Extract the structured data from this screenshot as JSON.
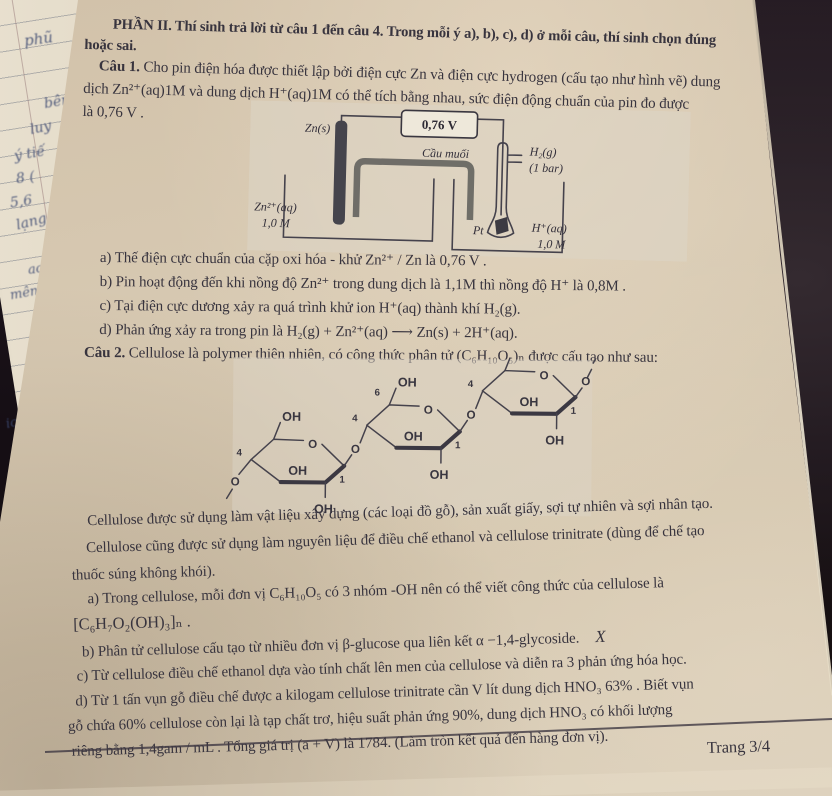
{
  "paper": {
    "header": {
      "line1": "PHẦN II. Thí sinh trả lời từ câu 1 đến câu 4. Trong mỗi ý a), b), c), d) ở mỗi câu, thí sinh chọn đúng",
      "line2": "hoặc sai."
    },
    "q1": {
      "label": "Câu 1.",
      "line1_rest": " Cho pin điện hóa được thiết lập bởi điện cực Zn và điện cực hydrogen (cấu tạo như hình vẽ) dung",
      "line2": "dịch Zn²⁺(aq)1M và dung dịch H⁺(aq)1M có thể tích bằng nhau, sức điện động chuẩn của pin đo được",
      "line3": "là 0,76 V ."
    },
    "diagram": {
      "voltmeter": "0,76 V",
      "zn_label": "Zn(s)",
      "salt_bridge": "Cầu muối",
      "h2": "H₂(g)",
      "bar": "(1 bar)",
      "zn_sol": "Zn²⁺(aq)",
      "zn_conc": "1,0 M",
      "pt": "Pt",
      "h_sol": "H⁺(aq)",
      "h_conc": "1,0 M"
    },
    "q1_opts": {
      "a": "a) Thế điện cực chuẩn của cặp oxi hóa - khử Zn²⁺ / Zn là 0,76 V .",
      "b": "b) Pin hoạt động đến khi nồng độ Zn²⁺ trong dung dịch là 1,1M thì nồng độ H⁺ là 0,8M .",
      "c": "c) Tại điện cực dương xảy ra quá trình khử ion H⁺(aq) thành khí H₂(g).",
      "d": "d) Phản ứng xảy ra trong pin là H₂(g) + Zn²⁺(aq) ⟶ Zn(s) + 2H⁺(aq)."
    },
    "q2": {
      "label": "Câu 2.",
      "intro": " Cellulose là polymer thiên nhiên, có công thức phân tử (C₆H₁₀O₅)ₙ được cấu tạo như sau:"
    },
    "structure": {
      "oh": "OH",
      "o": "O",
      "c1": "1",
      "c4": "4",
      "c6": "6"
    },
    "q2_text": {
      "p1": "Cellulose được sử dụng làm vật liệu xây dựng (các loại đồ gỗ), sản xuất giấy, sợi tự nhiên và sợi nhân tạo.",
      "p2": "Cellulose cũng được sử dụng làm nguyên liệu để điều chế ethanol và cellulose trinitrate (dùng để chế tạo",
      "p3": "thuốc súng không khói)."
    },
    "q2_opts": {
      "a1": "a) Trong cellulose, mỗi đơn vị C₆H₁₀O₅ có 3 nhóm -OH nên có thể viết công thức của cellulose là",
      "a2": "[C₆H₇O₂(OH)₃]ₙ .",
      "b": "b) Phân tử cellulose cấu tạo từ nhiều đơn vị β-glucose qua liên kết α −1,4-glycoside.",
      "b_mark": "X",
      "c": "c) Từ cellulose điều chế ethanol dựa vào tính chất lên men của cellulose và diễn ra 3 phản ứng hóa học.",
      "d1": "d) Từ 1 tấn vụn gỗ điều chế được a kilogam cellulose trinitrate cần V lít dung dịch HNO₃ 63% . Biết vụn",
      "d2": "gỗ chứa 60% cellulose còn lại là tạp chất trơ, hiệu suất phản ứng 90%, dung dịch HNO₃ có khối lượng",
      "d3": "riêng bằng 1,4gam / mL . Tổng giá trị (a + V) là 1784. (Làm tròn kết quả đến hàng đơn vị)."
    },
    "footer": {
      "page": "Trang 3/4"
    }
  },
  "notebook": {
    "f1": "phũ",
    "f2": "bên",
    "f3": "luy",
    "f4": "ý tiế",
    "f5": "8 (",
    "f6": "5,6",
    "f7": "lạng",
    "f8": "ac",
    "f9": "mên",
    "f10": "ic"
  },
  "colors": {
    "paper": "#d6c8b1",
    "ink": "#38343e",
    "dark_bg": "#18121a",
    "handwriting": "#3d4a72"
  }
}
